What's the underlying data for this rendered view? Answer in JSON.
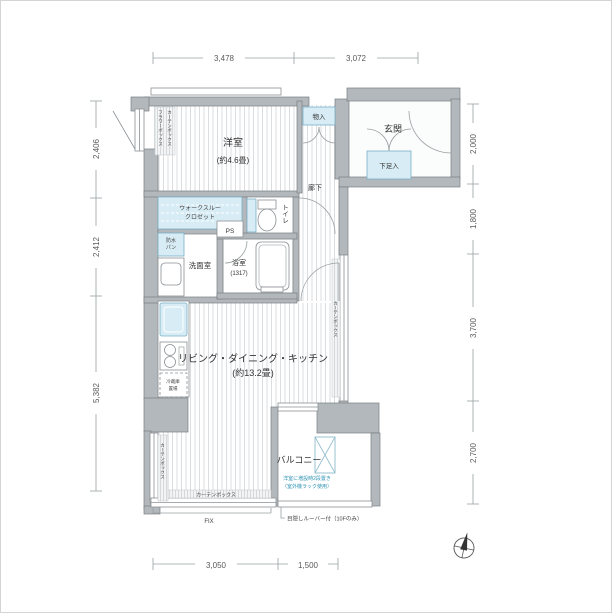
{
  "plan": {
    "labels": {
      "yoshitsu": "洋室",
      "yoshitsu_size": "(約4.6畳)",
      "monoire": "物入",
      "genkan": "玄関",
      "getabako": "下足入",
      "rouka": "廊下",
      "toire": "トイレ",
      "wtc1": "ウォークスルー",
      "wtc2": "クロゼット",
      "ps": "PS",
      "bousui1": "防水",
      "bousui2": "パン",
      "senmenshitsu": "洗面室",
      "yokushitsu": "浴室",
      "yokushitsu_size": "(1317)",
      "ldk": "リビング・ダイニング・キッチン",
      "ldk_size": "(約13.2畳)",
      "balcony": "バルコニー",
      "reizouko1": "冷蔵庫",
      "reizouko2": "置場",
      "curtain_box": "カーテンボックス",
      "flower_box": "フラワーボックス",
      "fix": "FIX",
      "louver": "目隠しルーバー付（10Fのみ）",
      "balcony_note1": "洋室に増設時2段置き",
      "balcony_note2": "（室外機ラック使用）"
    },
    "dimensions": {
      "top": [
        "3,478",
        "3,072"
      ],
      "left": [
        "2,406",
        "2,412",
        "5,382"
      ],
      "right": [
        "2,000",
        "1,800",
        "3,700",
        "2,700"
      ],
      "bottom": [
        "3,050",
        "1,500"
      ]
    },
    "colors": {
      "wall": "#b2b8bc",
      "fixture_blue": "#d7ecf4",
      "note_blue": "#2f93b4",
      "dim_gray": "#9aa0a3"
    }
  }
}
